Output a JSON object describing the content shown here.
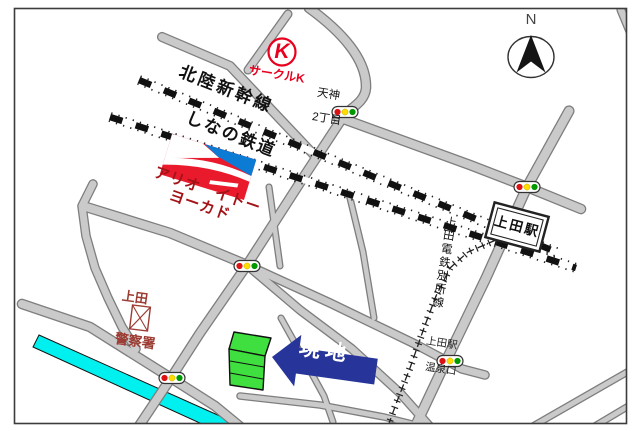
{
  "compass": {
    "label": "N"
  },
  "railways": {
    "hokuriku_shinkansen": "北陸新幹線",
    "shinano_tetsudo": "しなの鉄道",
    "ueda_dentetsu_bessho": "上田電鉄別所線"
  },
  "stations": {
    "ueda_station_box": "上田駅"
  },
  "landmarks": {
    "circle_k": {
      "initial": "K",
      "name": "サークルK"
    },
    "ario_ito_yokado": {
      "line1": "アリオ　イトー",
      "line2": "ヨーカド"
    },
    "police": {
      "line1": "上田",
      "line2": "警察署"
    },
    "site": {
      "label": "現地"
    }
  },
  "intersections": {
    "tenjin": {
      "line1": "天神",
      "line2": "2丁目"
    },
    "onsenguchi": {
      "line1": "上田駅",
      "line2": "温泉口"
    }
  },
  "colors": {
    "road_fill": "#cacaca",
    "road_edge": "#7e7e7e",
    "river": "#00efef",
    "frame": "#3c3c3c",
    "signal_red": "#dd1111",
    "signal_yellow": "#ffdd00",
    "signal_green": "#009900",
    "circle_k_red": "#e8001e",
    "ario_red": "#ea1a2d",
    "ario_blue": "#0b7bd4",
    "ario_text": "#a21418",
    "police_text": "#9c3b32",
    "site_arrow": "#27359b",
    "site_building": "#3fdf3f"
  }
}
